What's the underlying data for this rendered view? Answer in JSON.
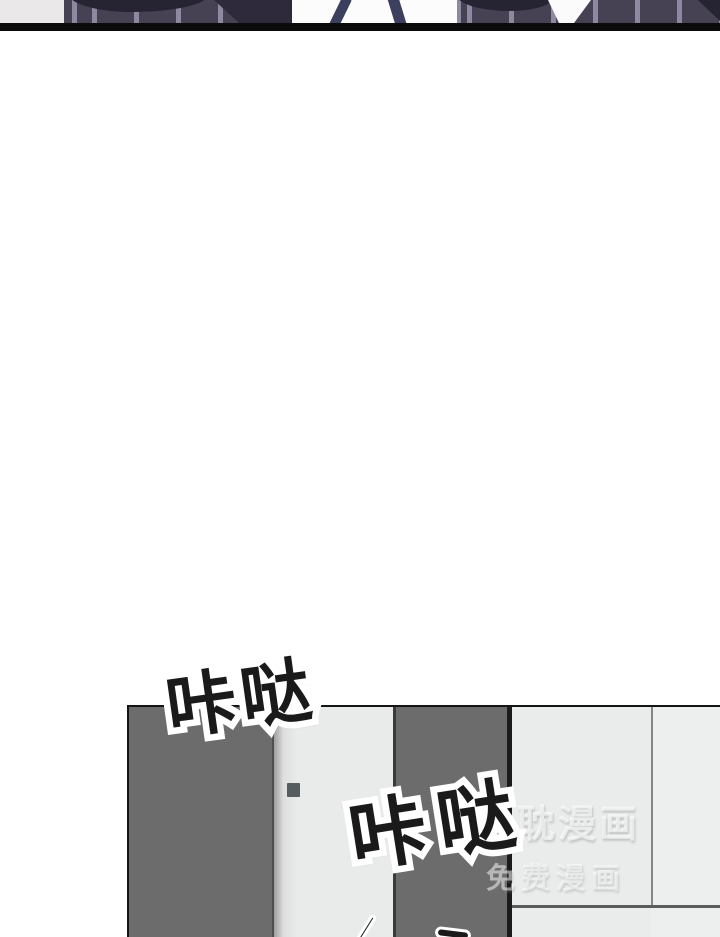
{
  "comic": {
    "sound_effects": {
      "first": "咔哒",
      "second": "咔哒"
    },
    "watermark": {
      "line1": "兔耽漫画",
      "line2": "免费漫画"
    }
  },
  "colors": {
    "suit_fabric": "#474253",
    "suit_stripe": "#8e88a0",
    "suit_shadow": "#262333",
    "shirt": "#fcfcfd",
    "suspender": "#3d3f5e",
    "panel_divider_line": "#0b0b0b",
    "door_dark": "#6c6c6c",
    "door_light": "#e9ebea",
    "wall_light": "#e9eceb",
    "wall_right": "#ecefee",
    "door_handle": "#575d5f",
    "sfx_fill": "#1a1a1a",
    "sfx_outline": "#ffffff",
    "watermark_text": "#ffffff"
  }
}
